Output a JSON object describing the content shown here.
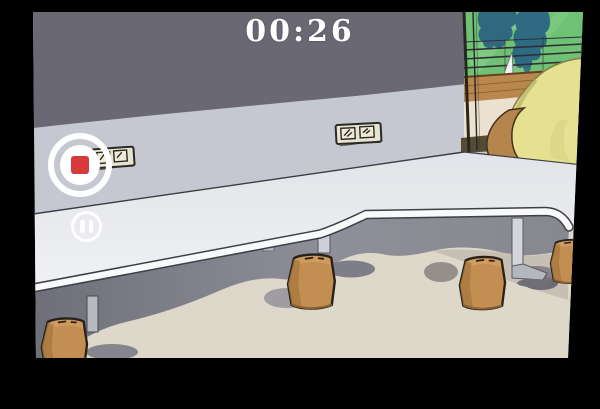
{
  "recorder": {
    "timer": "00:26",
    "controls": {
      "stop": {
        "icon": "stop-icon",
        "color": "#d8393b"
      },
      "pause": {
        "icon": "pause-icon",
        "color": "#ffffff"
      }
    },
    "timer_color": "#ffffff"
  },
  "frame": {
    "letterbox_color": "#000000"
  },
  "scene": {
    "type": "cartoon-room-illustration",
    "objects": [
      "upper-wall",
      "lower-wall",
      "power-outlet",
      "power-outlet",
      "window",
      "tree-silhouettes",
      "balcony-railing",
      "sail",
      "wood-deck",
      "window-sill",
      "yellow-beanbag",
      "tan-cushion",
      "desk",
      "desk-leg",
      "desk-leg",
      "pedestal-leg",
      "stool",
      "stool",
      "stool",
      "stool",
      "floor",
      "under-table-shadow"
    ],
    "colors": {
      "upper_wall": "#696873",
      "lower_wall": "#c5c8d0",
      "desk_top": "#e9ebef",
      "desk_edge": "#f8f9fb",
      "floor": "#ded8cb",
      "shadow": "#82828c",
      "stool": "#c38e52",
      "window_green": "#6fc175",
      "tree": "#2e6b83",
      "deck_brown": "#b9884e",
      "beanbag_yellow": "#e5e191",
      "outlet_cream": "#e9e3d3"
    }
  }
}
